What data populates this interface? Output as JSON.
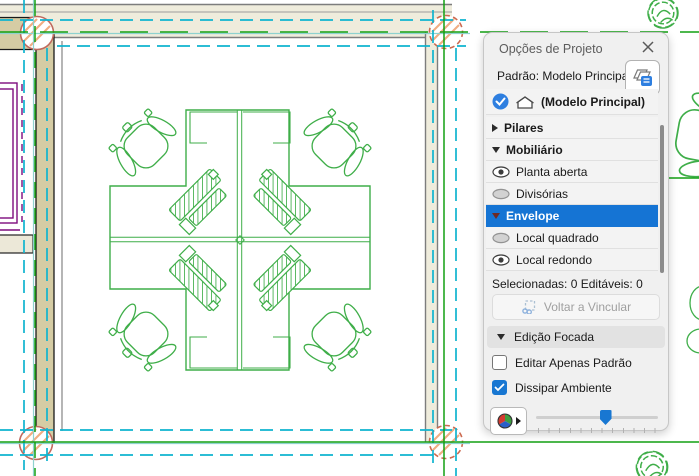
{
  "panel": {
    "title": "Opções de Projeto",
    "default_model_label": "Padrão: Modelo Principal",
    "main_model_row": {
      "label": "(Modelo Principal)"
    },
    "tree": [
      {
        "label": "Pilares",
        "type": "category",
        "state": "collapsed"
      },
      {
        "label": "Mobiliário",
        "type": "category",
        "state": "expanded"
      },
      {
        "label": "Planta aberta",
        "type": "option",
        "visibility": "visible"
      },
      {
        "label": "Divisórias",
        "type": "option",
        "visibility": "hidden"
      },
      {
        "label": "Envelope",
        "type": "category",
        "state": "expanded",
        "selected": true
      },
      {
        "label": "Local quadrado",
        "type": "option",
        "visibility": "hidden"
      },
      {
        "label": "Local redondo",
        "type": "option",
        "visibility": "visible"
      }
    ],
    "selection_status": "Selecionadas: 0 Editáveis: 0",
    "relink_button_label": "Voltar a Vincular",
    "focused_editing_header": "Edição Focada",
    "checkbox_edit_primary": {
      "label": "Editar Apenas Padrão",
      "checked": false
    },
    "checkbox_fade_environment": {
      "label": "Dissipar Ambiente",
      "checked": true
    },
    "slider": {
      "value_percent": 57
    }
  },
  "canvas": {
    "colors": {
      "wall_tan": "#d5cca4",
      "wall_light": "#efecdc",
      "furniture_green": "#3fae49",
      "reference_green": "#12a012",
      "reference_cyan": "#0fb4cf",
      "reference_teal": "#8fd2cf",
      "column_salmon": "#c06a5e",
      "column_hatch": "#f0ad83",
      "option_purple": "#7d0c7d"
    }
  }
}
